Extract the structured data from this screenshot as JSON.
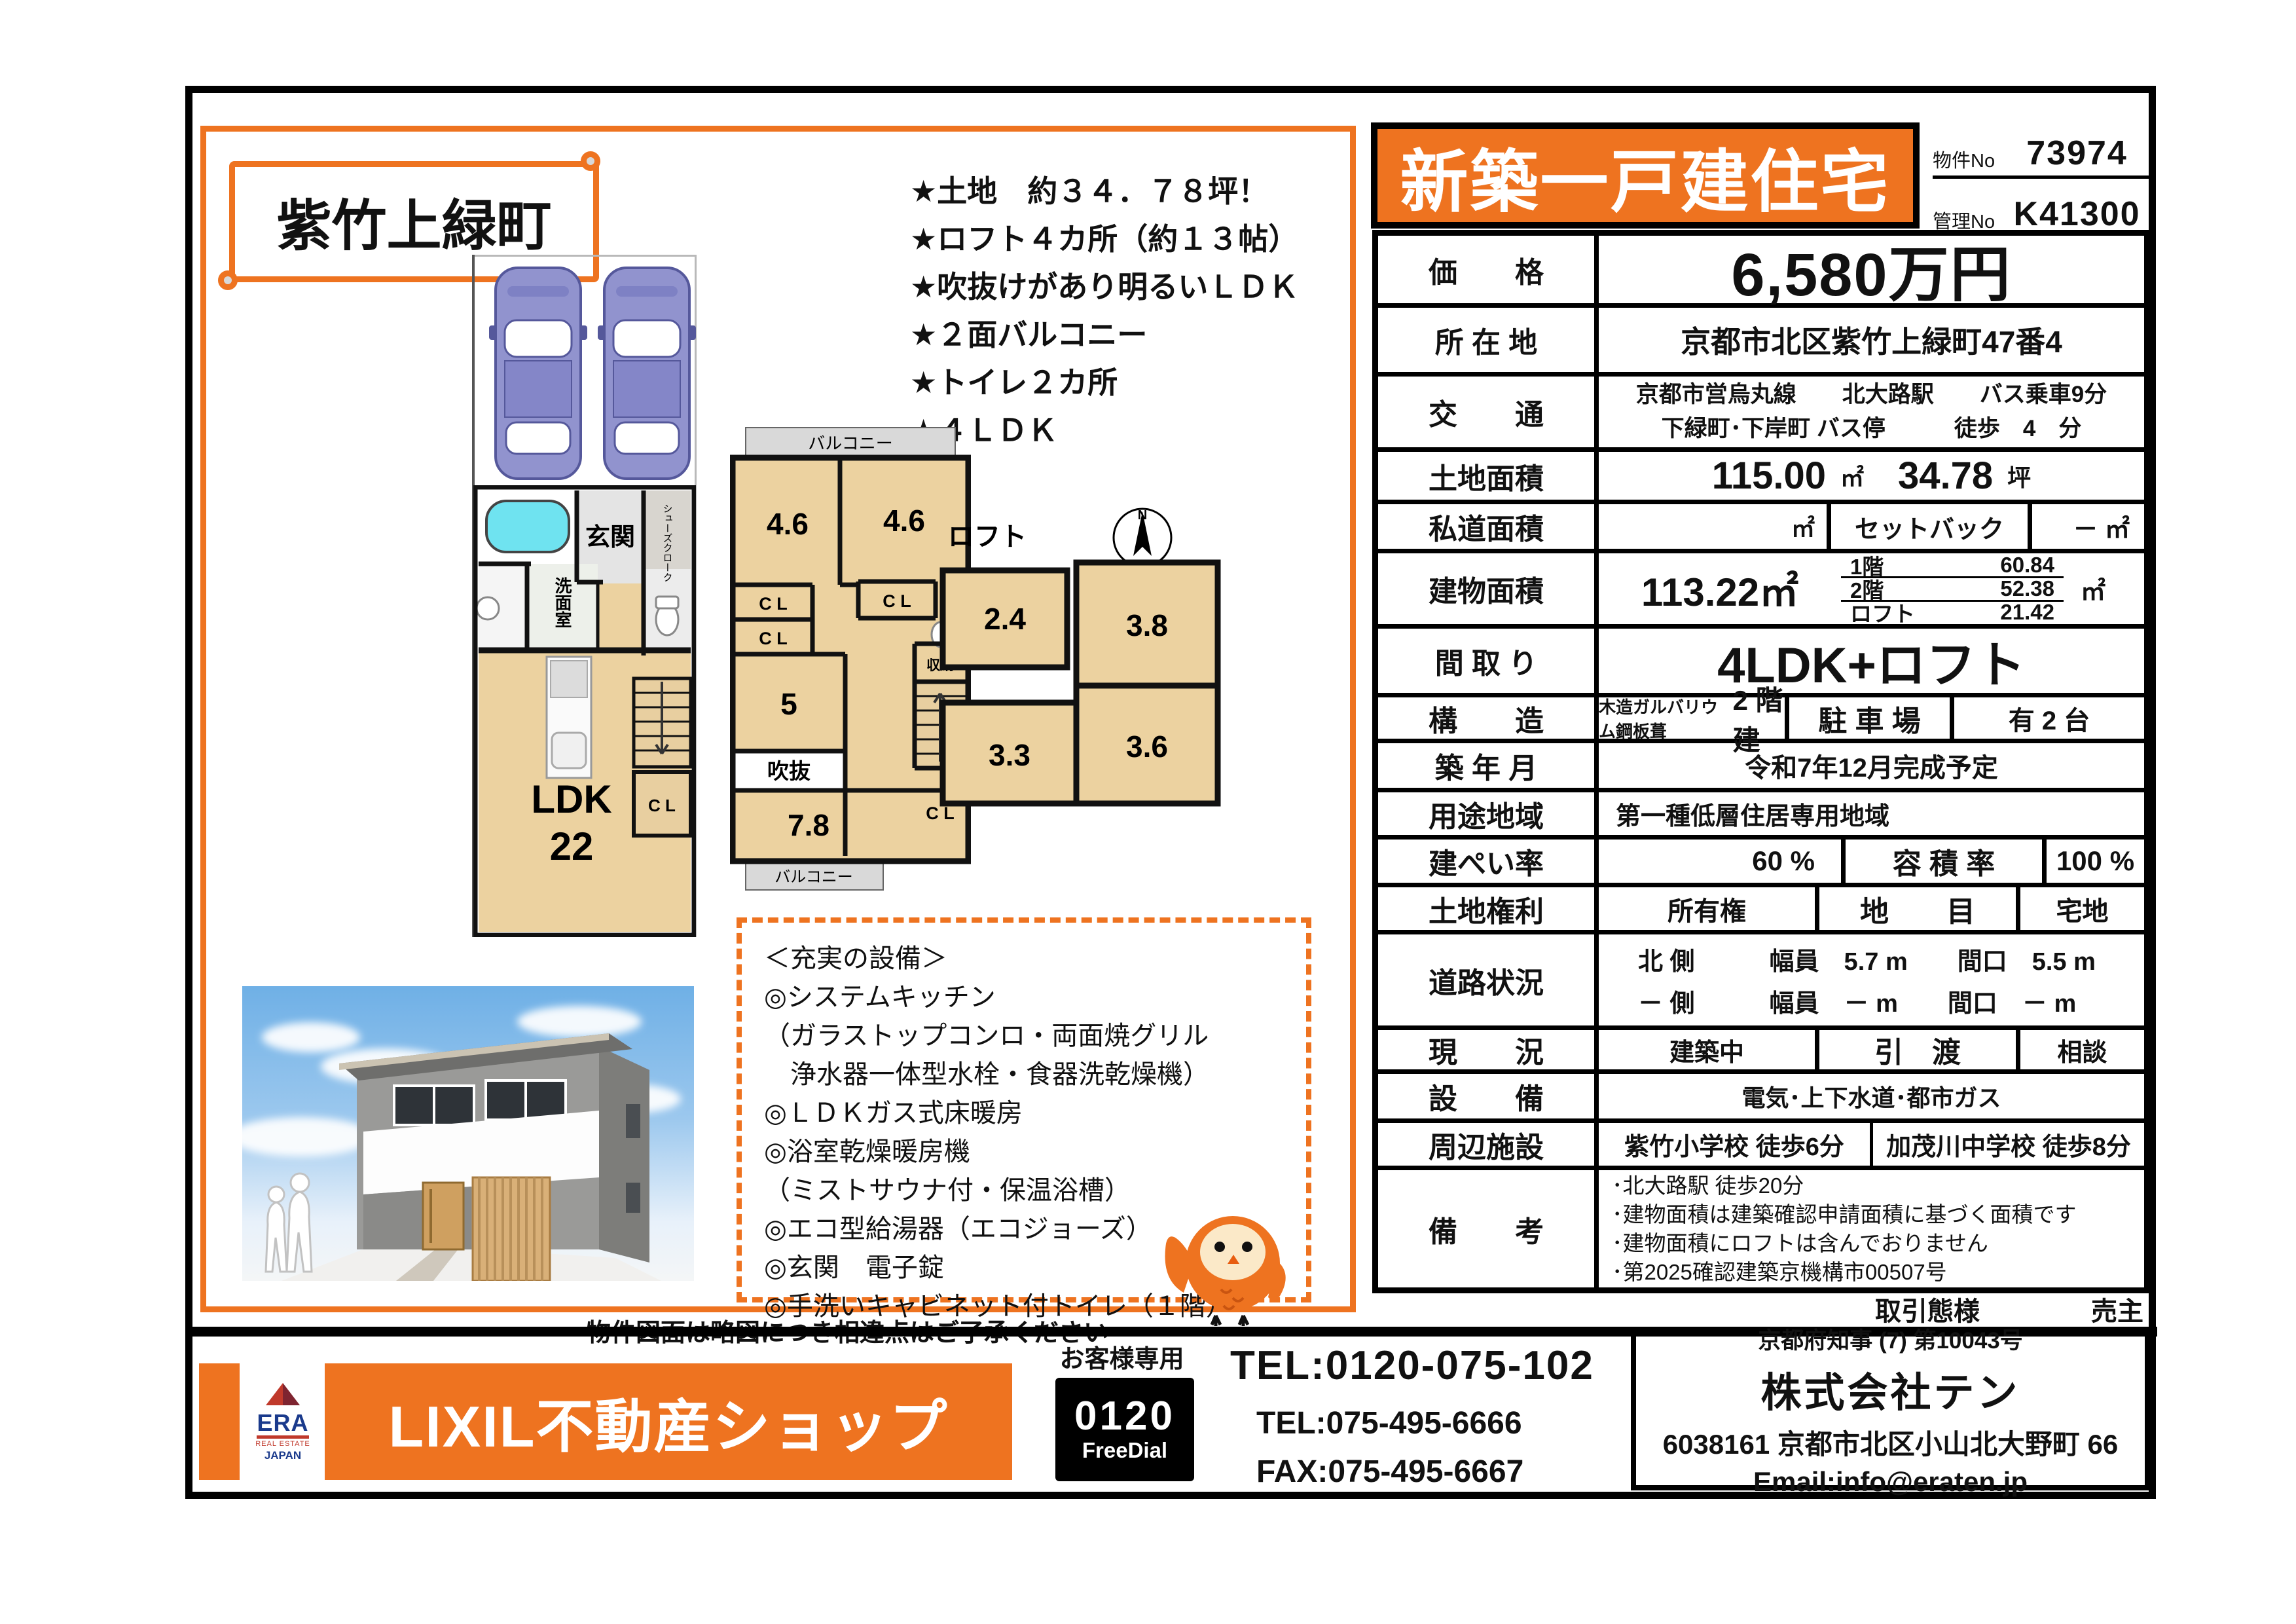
{
  "header": {
    "title": "新築一戸建住宅",
    "property_no_label": "物件No",
    "property_no_value": "73974",
    "control_no_label": "管理No",
    "control_no_value": "K41300"
  },
  "left_panel": {
    "town_name": "紫竹上緑町",
    "features": [
      "★土地　約３４．７８坪！",
      "★ロフト４カ所（約１３帖）",
      "★吹抜けがあり明るいＬＤＫ",
      "★２面バルコニー",
      "★トイレ２カ所",
      "★４ＬＤＫ"
    ],
    "plan_1f": {
      "entrance": "玄関",
      "shoes": "シューズクローク",
      "wash": "洗面室",
      "ldk_label": "LDK",
      "ldk_size": "22",
      "cl": "C L"
    },
    "plan_2f": {
      "balcony_top": "バルコニー",
      "balcony_bottom": "バルコニー",
      "room_left": "4.6",
      "room_right": "4.6",
      "cl_right": "C L",
      "cl_left1": "C L",
      "cl_left2": "C L",
      "room_mid": "5",
      "void": "吹抜",
      "storage": "収納",
      "room_bottom": "7.8",
      "cl_bottom": "C L"
    },
    "loft": {
      "title": "ロフト",
      "north": "N",
      "room1": "2.4",
      "room2": "3.8",
      "room3": "3.6",
      "room4": "3.3"
    },
    "equipment": {
      "title": "＜充実の設備＞",
      "lines": [
        "◎システムキッチン",
        "（ガラストップコンロ・両面焼グリル",
        "　浄水器一体型水栓・食器洗乾燥機）",
        "◎ＬＤＫガス式床暖房",
        "◎浴室乾燥暖房機",
        "（ミストサウナ付・保温浴槽）",
        "◎エコ型給湯器（エコジョーズ）",
        "◎玄関　電子錠",
        "◎手洗いキャビネット付トイレ（１階）"
      ]
    }
  },
  "table": {
    "price": {
      "label": "価　　格",
      "value": "6,580万円"
    },
    "location": {
      "label": "所 在 地",
      "value": "京都市北区紫竹上緑町47番4"
    },
    "access": {
      "label": "交　　通",
      "line1": "京都市営烏丸線　　北大路駅　　バス乗車9分",
      "line2": "下緑町･下岸町 バス停　　　徒歩　4　分"
    },
    "land_area": {
      "label": "土地面積",
      "m2": "115.00",
      "m2_unit": "㎡",
      "tsubo": "34.78",
      "tsubo_unit": "坪"
    },
    "private_road": {
      "label": "私道面積",
      "unit": "㎡",
      "setback_label": "セットバック",
      "setback_value": "－ ㎡"
    },
    "building_area": {
      "label": "建物面積",
      "total": "113.22㎡",
      "f1_label": "1階",
      "f1": "60.84",
      "f2_label": "2階",
      "f2": "52.38",
      "loft_label": "ロフト",
      "loft": "21.42",
      "unit": "㎡"
    },
    "layout": {
      "label": "間 取 り",
      "value": "4LDK+ロフト"
    },
    "structure": {
      "label": "構　　造",
      "small": "木造ガルバリウム鋼板葺",
      "big": "2 階建",
      "parking_label": "駐 車 場",
      "parking_value": "有 2 台"
    },
    "built": {
      "label": "築 年 月",
      "value": "令和7年12月完成予定"
    },
    "zoning": {
      "label": "用途地域",
      "value": "第一種低層住居専用地域"
    },
    "coverage": {
      "label": "建ぺい率",
      "value": "60 %",
      "far_label": "容 積 率",
      "far_value": "100 %"
    },
    "land_right": {
      "label": "土地権利",
      "value": "所有権",
      "category_label": "地　　目",
      "category_value": "宅地"
    },
    "road": {
      "label": "道路状況",
      "line1": "北 側　　　幅員　5.7 m　　間口　5.5 m",
      "line2": "－ 側　　　幅員　－ m　　間口　－ m"
    },
    "status": {
      "label": "現　　況",
      "value": "建築中",
      "handover_label": "引　渡",
      "handover_value": "相談"
    },
    "utilities": {
      "label": "設　　備",
      "value": "電気･上下水道･都市ガス"
    },
    "nearby": {
      "label": "周辺施設",
      "school1": "紫竹小学校 徒歩6分",
      "school2": "加茂川中学校 徒歩8分"
    },
    "remarks": {
      "label": "備　　考",
      "lines": [
        "･北大路駅 徒歩20分",
        "･建物面積は建築確認申請面積に基づく面積です",
        "･建物面積にロフトは含んでおりません",
        "･第2025確認建築京機構市00507号"
      ]
    },
    "deal": {
      "label": "取引態様",
      "value": "売主"
    }
  },
  "footer": {
    "note": "物件図面は略図につき相違点はご了承ください",
    "brand": "LIXIL不動産ショップ",
    "era": {
      "name": "ERA",
      "sub": "REAL ESTATE",
      "country": "JAPAN"
    },
    "customer_label": "お客様専用",
    "freedial_number": "0120",
    "freedial_label": "FreeDial",
    "tel_free": "TEL:0120-075-102",
    "tel": "TEL:075-495-6666",
    "fax": "FAX:075-495-6667",
    "license": "京都府知事 (7) 第10043号",
    "company": "株式会社テン",
    "address": "6038161 京都市北区小山北大野町 66",
    "email": "Email:info@eraten.jp"
  },
  "colors": {
    "accent_orange": "#ee7320",
    "floor_beige": "#ecd2a0",
    "balcony_gray": "#d9d9d9",
    "car_purple": "#9193ce"
  }
}
